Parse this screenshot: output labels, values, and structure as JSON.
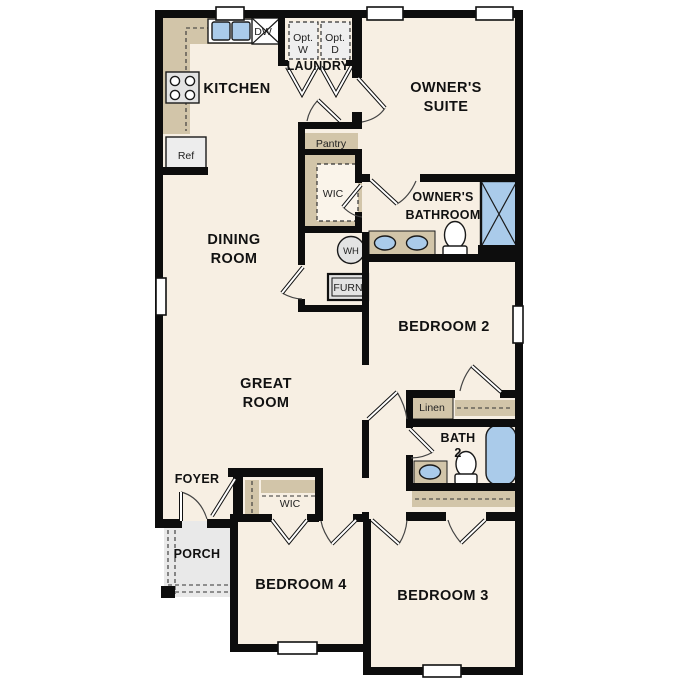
{
  "plan": {
    "rooms": {
      "kitchen": {
        "label": "KITCHEN"
      },
      "laundry": {
        "label": "LAUNDRY"
      },
      "owners_suite": {
        "lines": [
          "OWNER'S",
          "SUITE"
        ]
      },
      "owners_bathroom": {
        "lines": [
          "OWNER'S",
          "BATHROOM"
        ]
      },
      "dining_room": {
        "lines": [
          "DINING",
          "ROOM"
        ]
      },
      "great_room": {
        "lines": [
          "GREAT",
          "ROOM"
        ]
      },
      "bedroom2": {
        "label": "BEDROOM 2"
      },
      "bedroom3": {
        "label": "BEDROOM 3"
      },
      "bedroom4": {
        "label": "BEDROOM 4"
      },
      "bath2": {
        "lines": [
          "BATH",
          "2"
        ]
      },
      "foyer": {
        "label": "FOYER"
      },
      "porch": {
        "label": "PORCH"
      }
    },
    "fixtures": {
      "opt_washer": {
        "lines": [
          "Opt.",
          "W"
        ]
      },
      "opt_dryer": {
        "lines": [
          "Opt.",
          "D"
        ]
      },
      "dishwasher": {
        "label": "DW"
      },
      "refrigerator": {
        "label": "Ref"
      },
      "pantry": {
        "label": "Pantry"
      },
      "wic_owners": {
        "label": "WIC"
      },
      "wic_bedroom4": {
        "label": "WIC"
      },
      "water_heater": {
        "label": "WH"
      },
      "furnace": {
        "label": "FURN"
      },
      "linen": {
        "label": "Linen"
      }
    },
    "colors": {
      "wall": "#0d0d0d",
      "floor": "#f7efe3",
      "casework_tan": "#d2c5a9",
      "fixture_blue": "#aacbea",
      "appliance_gray": "#e3e3e3",
      "porch_gray": "#e9e9e9"
    }
  }
}
